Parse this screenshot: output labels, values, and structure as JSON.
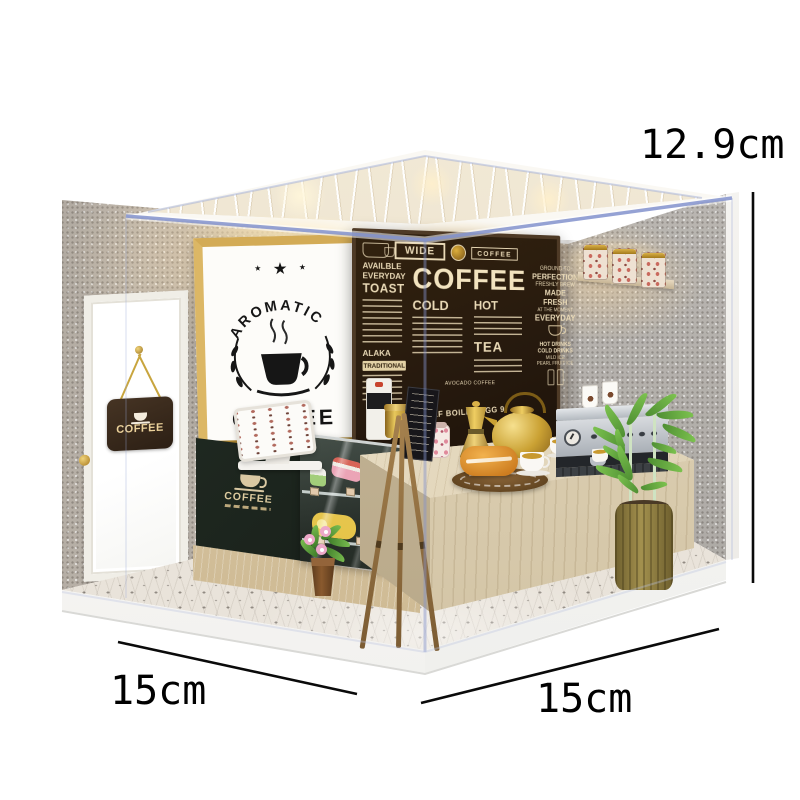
{
  "annotations": {
    "height": "12.9cm",
    "width_left": "15cm",
    "depth_right": "15cm"
  },
  "icons": {
    "star": "★"
  },
  "aromatic_sign": {
    "arc": "AROMATIC",
    "word": "COFFEE"
  },
  "door_sign": {
    "word": "COFFEE"
  },
  "cabinet_sign": {
    "word": "COFFEE"
  },
  "menu_board": {
    "header": {
      "wide": "WIDE",
      "coffee": "COFFEE"
    },
    "title": "COFFEE",
    "left": {
      "l1": "AVAILBLE",
      "l2": "EVERYDAY",
      "l3": "TOAST",
      "alaka": "ALAKA",
      "traditional": "TRADITIONAL"
    },
    "cold": "COLD",
    "hot": "HOT",
    "tea": "TEA",
    "avocado": "AVOCADO COFFEE",
    "right": {
      "l1": "GROUND TO",
      "l2": "PERFECTION",
      "l3": "FRESHLY BREW",
      "l4": "MADE FRESH",
      "l5": "AT THE MOMENT",
      "l6": "EVERYDAY",
      "d1": "HOT DRINKS",
      "d2": "COLD DRINKS",
      "d3": "MILD ICE",
      "d4": "PEARL FRUIT ICE"
    },
    "bottom": "HALF BOILED EGG 9."
  },
  "colors": {
    "background": "#ffffff",
    "acrylic_edge": "#8292cc",
    "menu_board_bg": "#2a1c12",
    "menu_board_text": "#e9d9b6",
    "sign_frame_wood": "#c49a4e",
    "counter_dark_green": "#1f2922",
    "light_wood": "#dccab0",
    "gold_metal": "#c9a227",
    "plant_green": "#6cb04a",
    "wall_speckle": "#c9c2ba",
    "tile_floor": "#e9e3da",
    "dimension_text": "#000000"
  }
}
